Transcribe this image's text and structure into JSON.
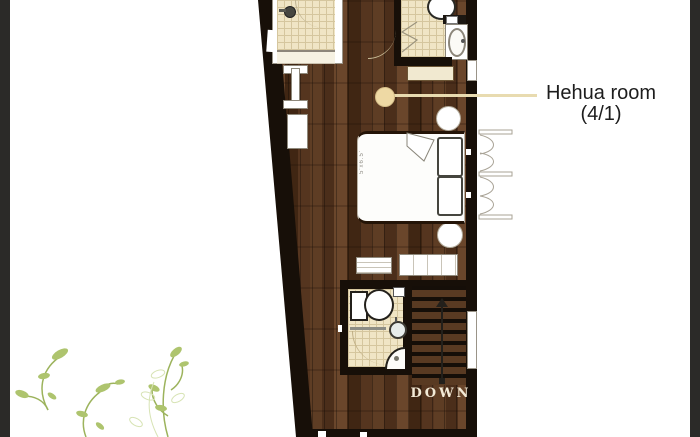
{
  "frame": {
    "background": "#ffffff",
    "left_bar_color": "#2b2a28",
    "right_bar_color": "#2b2a28"
  },
  "palette": {
    "wall": "#170f08",
    "wood_light": "#6a462b",
    "wood_mid": "#5e3d24",
    "wood_dark": "#402613",
    "tile": "#f0e5c5",
    "tile_grid": "#d5c69e",
    "leader_line": "#e8dbb0",
    "marker_dot": "#eed9a4",
    "label_text": "#1d1d1d",
    "down_text": "#f3ead6",
    "plant_green": "#aec46e"
  },
  "annotation": {
    "room_name": "Hehua room",
    "room_info": "(4/1)"
  },
  "bed": {
    "size_label": "5'x6.5'"
  },
  "stairs": {
    "label": "DOWN"
  },
  "icons": [
    "shower-head-icon",
    "toilet-icon",
    "sink-icon",
    "corner-shower-icon",
    "bifold-door-icon",
    "closet-doors-icon",
    "stairs-down-arrow-icon",
    "plant-decoration"
  ]
}
